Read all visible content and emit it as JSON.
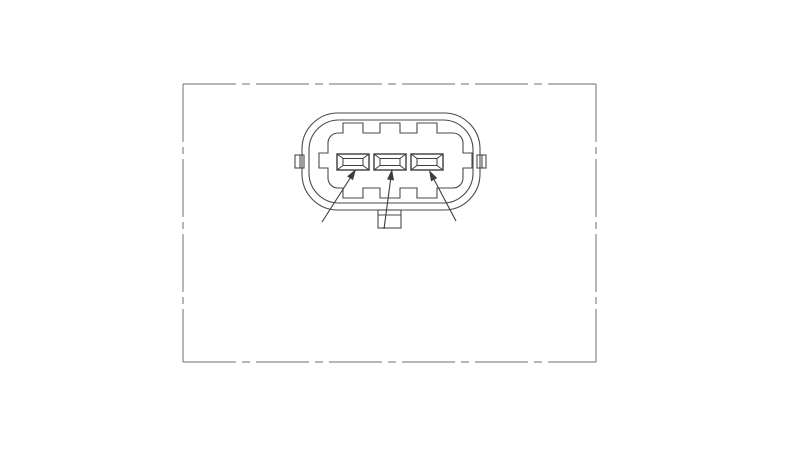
{
  "page": {
    "width": 800,
    "height": 451,
    "background": "#ffffff",
    "description": "Technical line drawing of a 3-pin sensor connector, face view, inside a phantom-line frame"
  },
  "colors": {
    "background": "#ffffff",
    "frame_line": "#6f6f6f",
    "outline": "#4a4a4a",
    "pin_line": "#3d3d3d",
    "arrow": "#3d3d3d"
  },
  "frame": {
    "x": 183,
    "y": 84,
    "width": 413,
    "height": 278,
    "line_width": 1,
    "dash_horizontal": "53 6 8 6",
    "dash_vertical": "58 5 7 5"
  },
  "connector": {
    "outer_shell": {
      "x": 302,
      "y": 113,
      "width": 178,
      "height": 97,
      "radius": 36
    },
    "inner_shell": {
      "x": 309,
      "y": 120,
      "width": 164,
      "height": 83,
      "radius": 30
    },
    "cavity": {
      "left": 328,
      "right": 463,
      "top": 133,
      "bottom": 188,
      "radius": 10,
      "notch_width": 20,
      "notch_depth": 10,
      "notch_centers_x": [
        353,
        390,
        427
      ],
      "side_notch": {
        "depth": 9,
        "top": 153,
        "bottom": 168
      }
    },
    "side_tabs": [
      {
        "x": 295,
        "y": 155,
        "width": 9,
        "height": 13,
        "divider_x": 300
      },
      {
        "x": 477,
        "y": 155,
        "width": 9,
        "height": 13,
        "divider_x": 482
      }
    ],
    "bottom_tab": {
      "x": 378,
      "y": 210,
      "width": 23,
      "height": 18,
      "inner_line_y": 215
    },
    "pins": {
      "centers_x": [
        353,
        390,
        427
      ],
      "top": 154,
      "width": 32,
      "height": 16,
      "inner_inset_x": 6,
      "inner_inset_y": 4.5
    }
  },
  "arrows": [
    {
      "from": [
        322,
        222
      ],
      "to": [
        356,
        169
      ]
    },
    {
      "from": [
        384,
        229
      ],
      "to": [
        392,
        169
      ]
    },
    {
      "from": [
        456,
        221
      ],
      "to": [
        429,
        170
      ]
    }
  ],
  "arrow_style": {
    "head_length": 11,
    "head_half_width": 3.5,
    "line_width": 1.1
  }
}
